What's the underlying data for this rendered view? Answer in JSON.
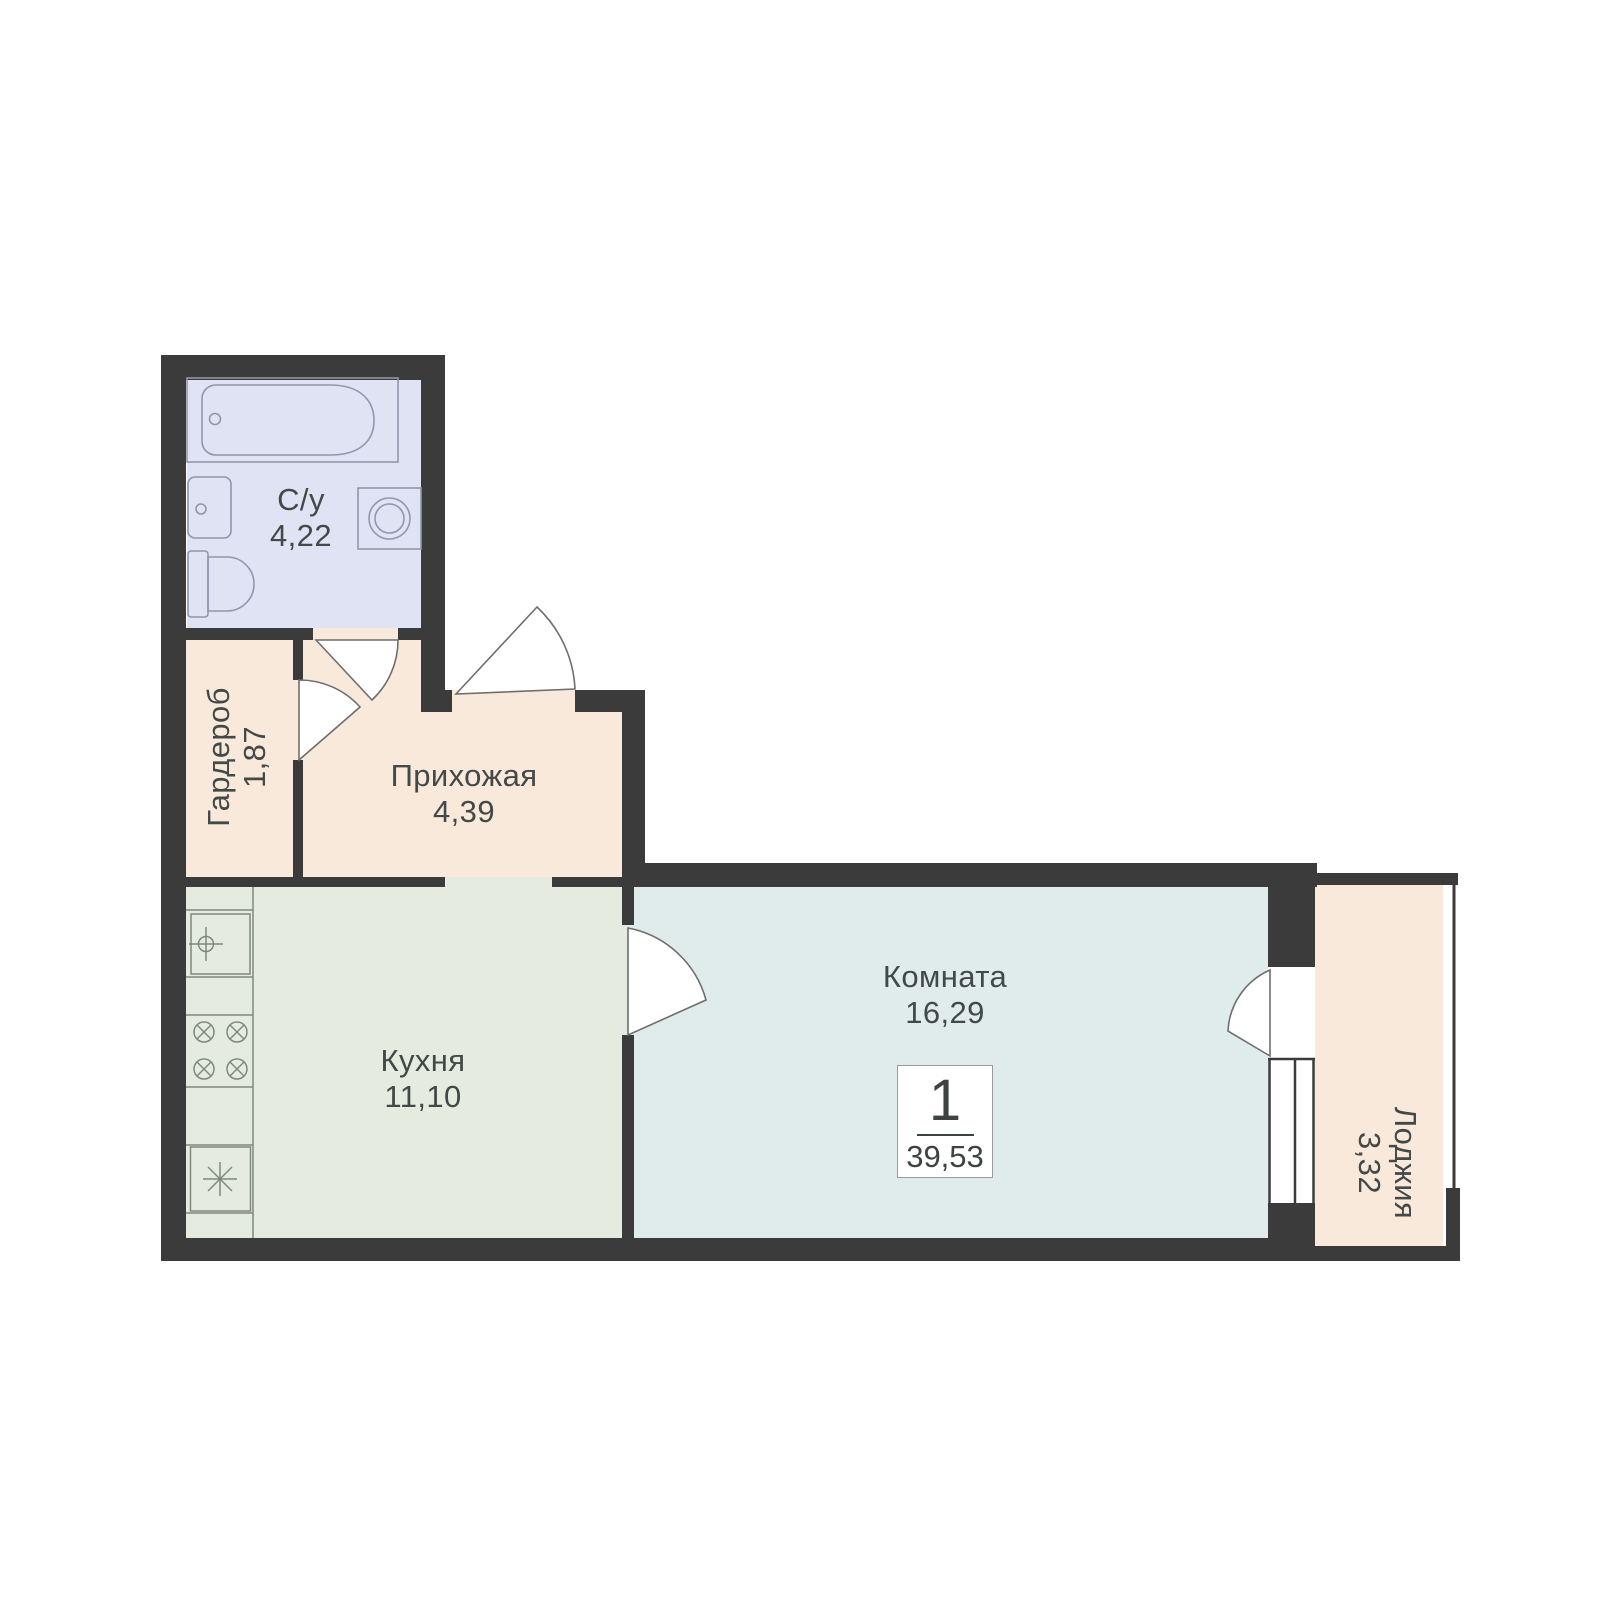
{
  "plan": {
    "rooms": [
      {
        "id": "bathroom",
        "label": "С/у",
        "area": "4,22",
        "color": "#dfe3f3"
      },
      {
        "id": "wardrobe",
        "label": "Гардероб",
        "area": "1,87",
        "color": "#f8e9da"
      },
      {
        "id": "hallway",
        "label": "Прихожая",
        "area": "4,39",
        "color": "#f8e9da"
      },
      {
        "id": "kitchen",
        "label": "Кухня",
        "area": "11,10",
        "color": "#e5ecdf"
      },
      {
        "id": "living-room",
        "label": "Комната",
        "area": "16,29",
        "color": "#dfeceb"
      },
      {
        "id": "loggia",
        "label": "Лоджия",
        "area": "3,32",
        "color": "#f8e9da"
      }
    ],
    "badge": {
      "rooms_count": "1",
      "total_area": "39,53"
    },
    "colors": {
      "walls": "#3b3b3b",
      "background": "#ffffff",
      "text": "#434848",
      "bath_fixture_stroke": "#9097ad",
      "kitchen_fixture_stroke": "#7f897b",
      "door_stroke": "#6e6e6e"
    },
    "fixtures": [
      "bathtub",
      "bath-sink",
      "toilet",
      "washing-machine",
      "kitchen-sink",
      "stove",
      "fridge",
      "window",
      "loggia-glazing"
    ]
  }
}
